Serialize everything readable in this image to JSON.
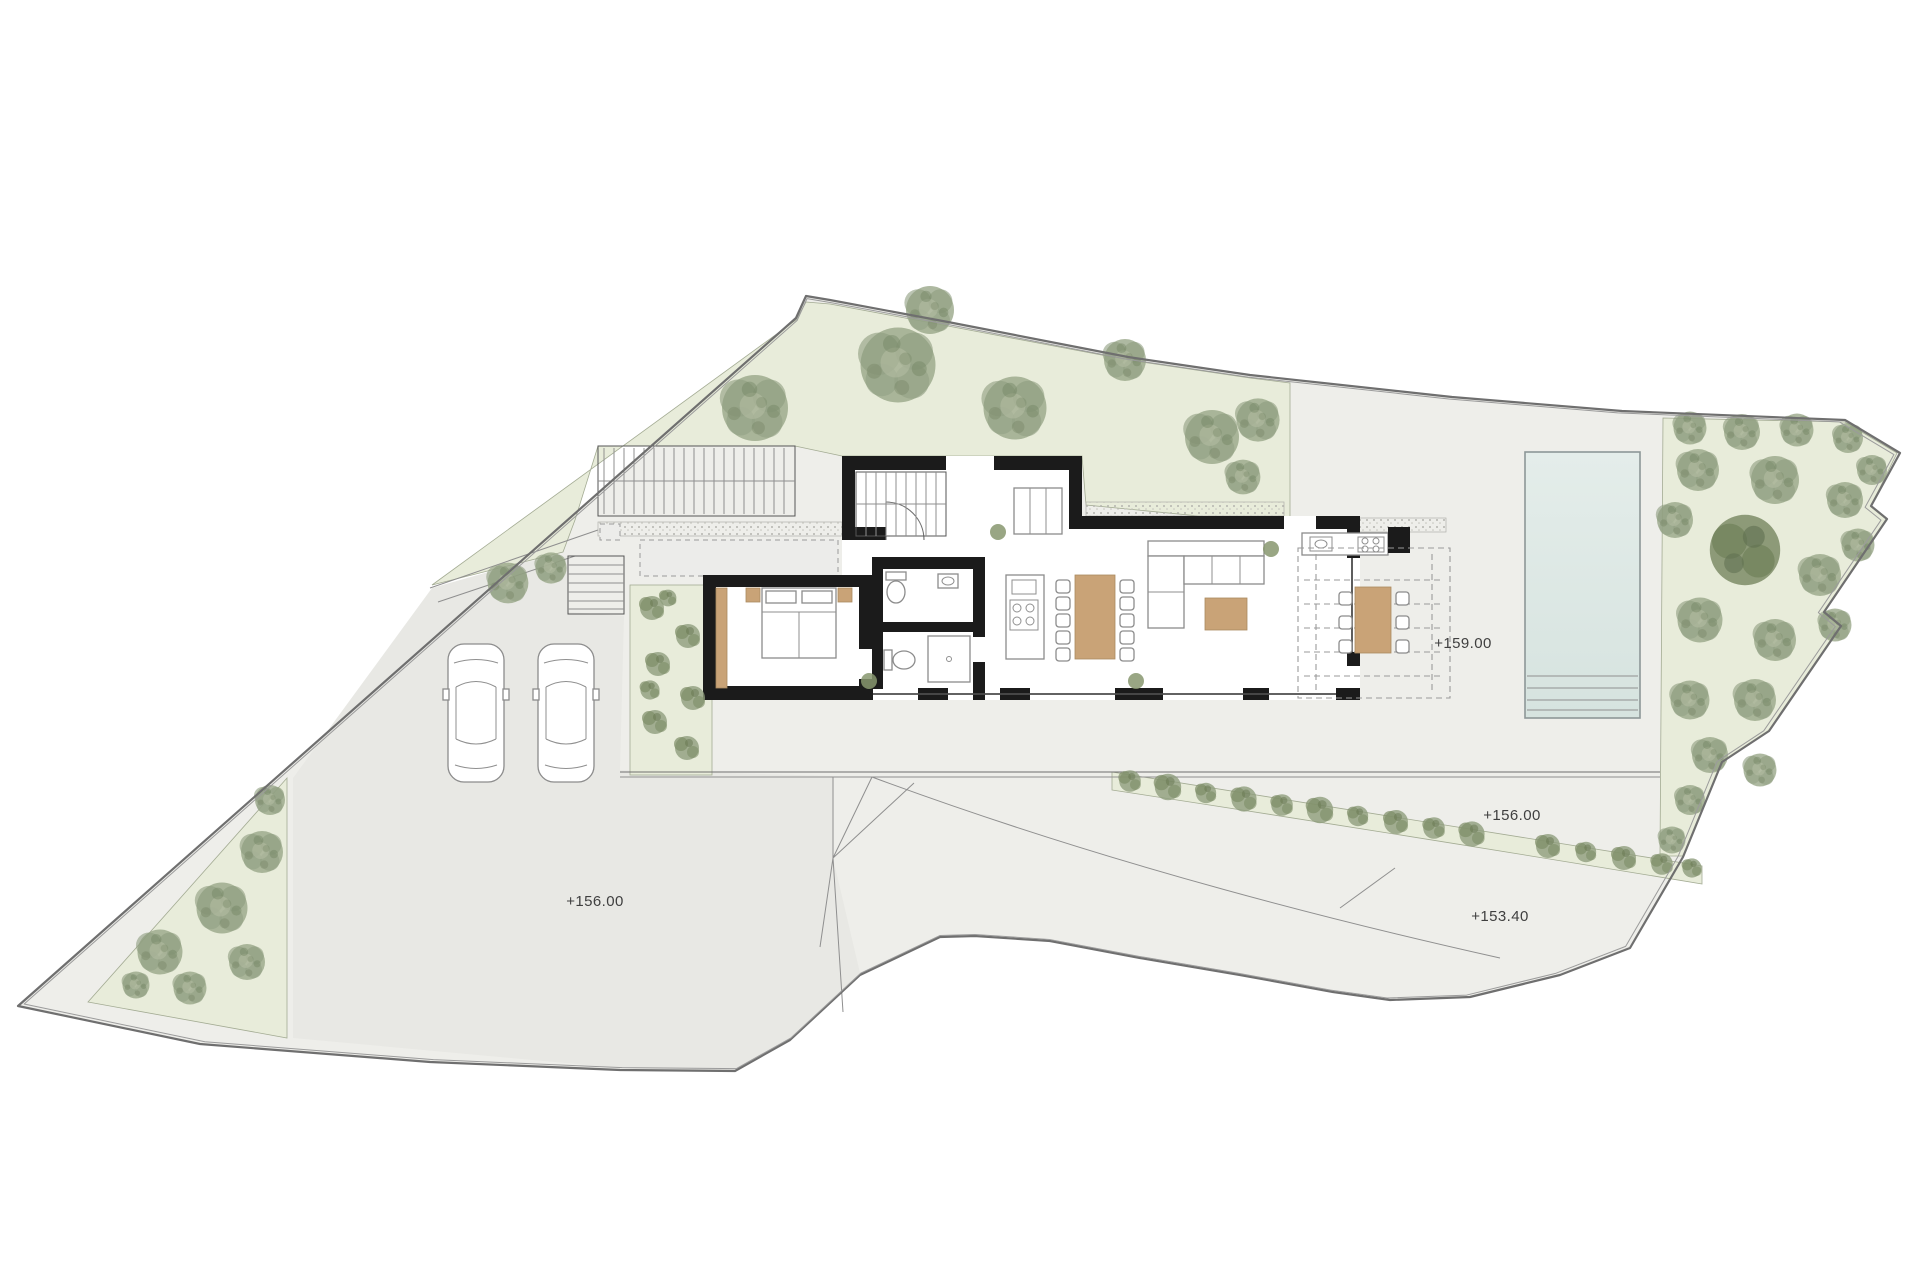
{
  "levels": {
    "pool_terrace": "+159.00",
    "driveway": "+156.00",
    "garden_slope": "+156.00",
    "lower_terrace": "+153.40"
  },
  "palette": {
    "paper": "#ffffff",
    "hardscape": "#eeeeea",
    "driveway": "#e8e8e4",
    "garden": "#e8ecda",
    "tree": "#94a283",
    "tree_dark": "#6f8060",
    "wall": "#1b1b1b",
    "wood": "#c9a377",
    "pool_water": "#dfe9e6",
    "pool_edge": "#8d9797",
    "line": "#6f6f6f",
    "label": "#3f3f3f"
  }
}
